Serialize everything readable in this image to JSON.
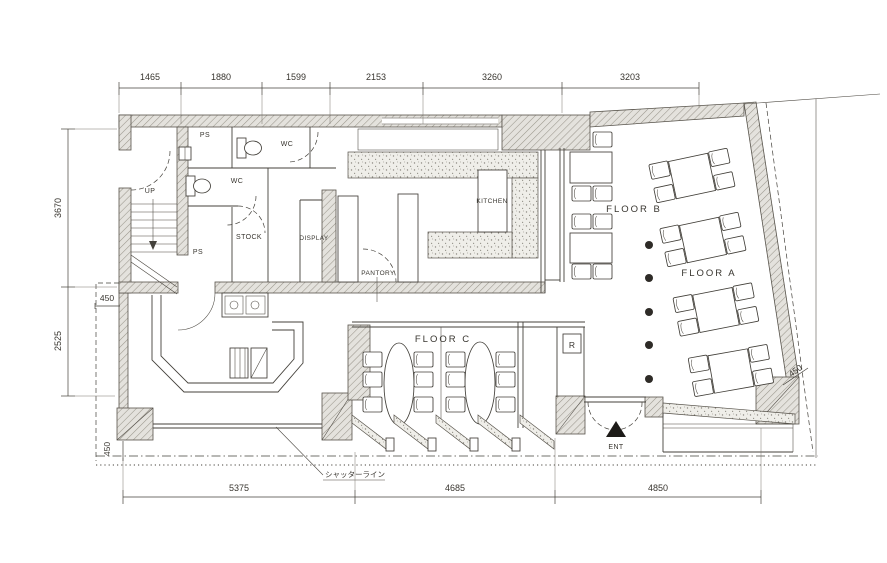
{
  "drawing": {
    "type": "restaurant-floor-plan",
    "colors": {
      "background": "#ffffff",
      "ink": "#38352f",
      "wall_fill": "#e4e2dd",
      "counter_fill": "#efeee9"
    }
  },
  "rooms": {
    "up": "UP",
    "ps_upper": "PS",
    "ps_lower": "PS",
    "wc_upper": "WC",
    "wc_lower": "WC",
    "stock": "STOCK",
    "display": "DISPLAY",
    "pantry": "PANTORY",
    "kitchen": "KITCHEN"
  },
  "areas": {
    "floor_a": "FLOOR A",
    "floor_b": "FLOOR B",
    "floor_c": "FLOOR C"
  },
  "annotations": {
    "register": "R",
    "entrance": "ENT",
    "shutter_line": "シャッターライン"
  },
  "dimensions": {
    "top": [
      "1465",
      "1880",
      "1599",
      "2153",
      "3260",
      "3203"
    ],
    "left": [
      "3670",
      "2525"
    ],
    "bottom": [
      "5375",
      "4685",
      "4850"
    ],
    "offset_left_top": "450",
    "offset_left_bottom": "450",
    "offset_right": "450"
  }
}
